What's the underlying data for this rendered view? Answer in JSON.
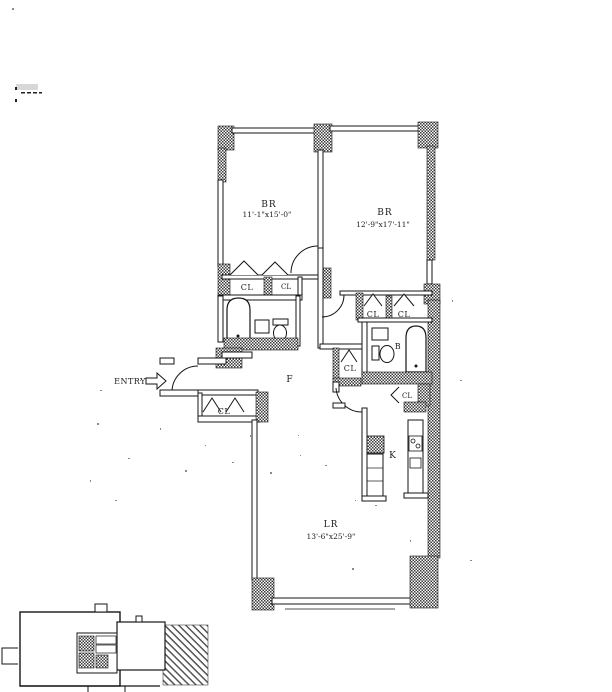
{
  "plan": {
    "entry_label": "ENTRY",
    "foyer_label": "F",
    "kitchen_label": "K",
    "bath_label": "B",
    "bedroom_left": {
      "label": "BR",
      "dims": "11'-1\"x15'-0\""
    },
    "bedroom_right": {
      "label": "BR",
      "dims": "12'-9\"x17'-11\""
    },
    "living_room": {
      "label": "LR",
      "dims": "13'-6\"x25'-9\""
    },
    "closets": {
      "bl1": "CL",
      "bl2": "CL",
      "entry": "CL",
      "hall": "CL",
      "brr1": "CL",
      "brr2": "CL",
      "kitchen": "CL"
    }
  },
  "colors": {
    "line": "#161616",
    "paper": "#ffffff"
  }
}
